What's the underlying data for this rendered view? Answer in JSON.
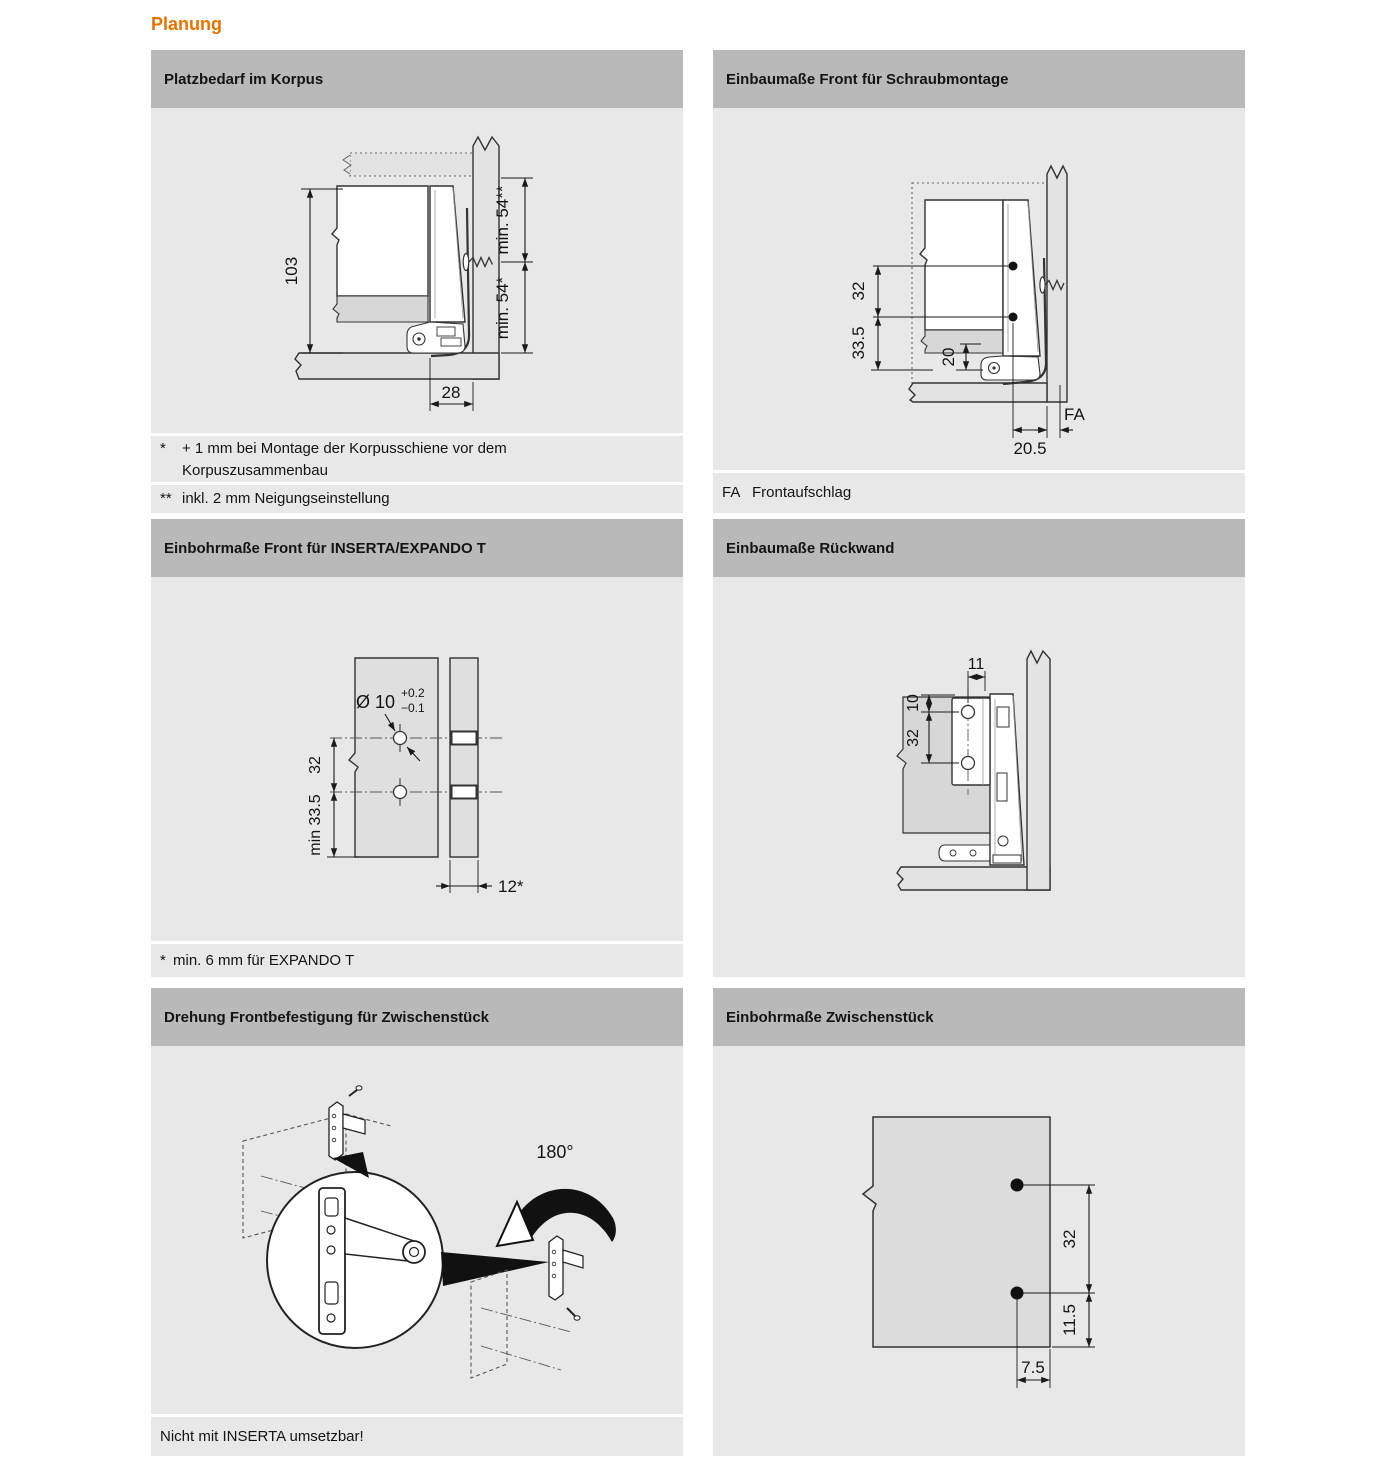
{
  "page_title": "Planung",
  "colors": {
    "accent": "#e87200",
    "header_bg": "#b9b9b9",
    "panel_bg": "#e8e8e8"
  },
  "panels": {
    "platzbedarf": {
      "title": "Platzbedarf im Korpus",
      "dims": {
        "height": "103",
        "depth": "28",
        "min_top": "min. 54**",
        "min_bottom": "min. 54*"
      },
      "footnote1_marker": "*",
      "footnote1": "+ 1 mm bei Montage der Korpusschiene vor dem Korpuszusammenbau",
      "footnote2_marker": "**",
      "footnote2": "inkl. 2 mm Neigungseinstellung"
    },
    "schraubmontage": {
      "title": "Einbaumaße Front für Schraubmontage",
      "dims": {
        "hole_spacing": "32",
        "bottom_offset": "33.5",
        "clearance": "20",
        "front_inset": "20.5",
        "fa": "FA"
      },
      "footnote_marker": "FA",
      "footnote": "Frontaufschlag"
    },
    "inserta": {
      "title": "Einbohrmaße Front für INSERTA/EXPANDO T",
      "dims": {
        "diameter": "Ø 10",
        "tol_plus": "+0.2",
        "tol_minus": "−0.1",
        "hole_spacing": "32",
        "bottom_offset": "min 33.5",
        "front_thickness": "12*"
      },
      "footnote_marker": "*",
      "footnote": "min. 6 mm für EXPANDO T"
    },
    "rueckwand": {
      "title": "Einbaumaße Rückwand",
      "dims": {
        "top_offset": "10",
        "side_offset": "11",
        "hole_spacing": "32"
      }
    },
    "drehung": {
      "title": "Drehung Frontbefestigung für Zwischenstück",
      "rotation_label": "180°",
      "footnote": "Nicht mit INSERTA umsetzbar!"
    },
    "zwischenstueck": {
      "title": "Einbohrmaße Zwischenstück",
      "dims": {
        "hole_spacing": "32",
        "bottom_offset": "11.5",
        "edge_offset": "7.5"
      }
    }
  }
}
